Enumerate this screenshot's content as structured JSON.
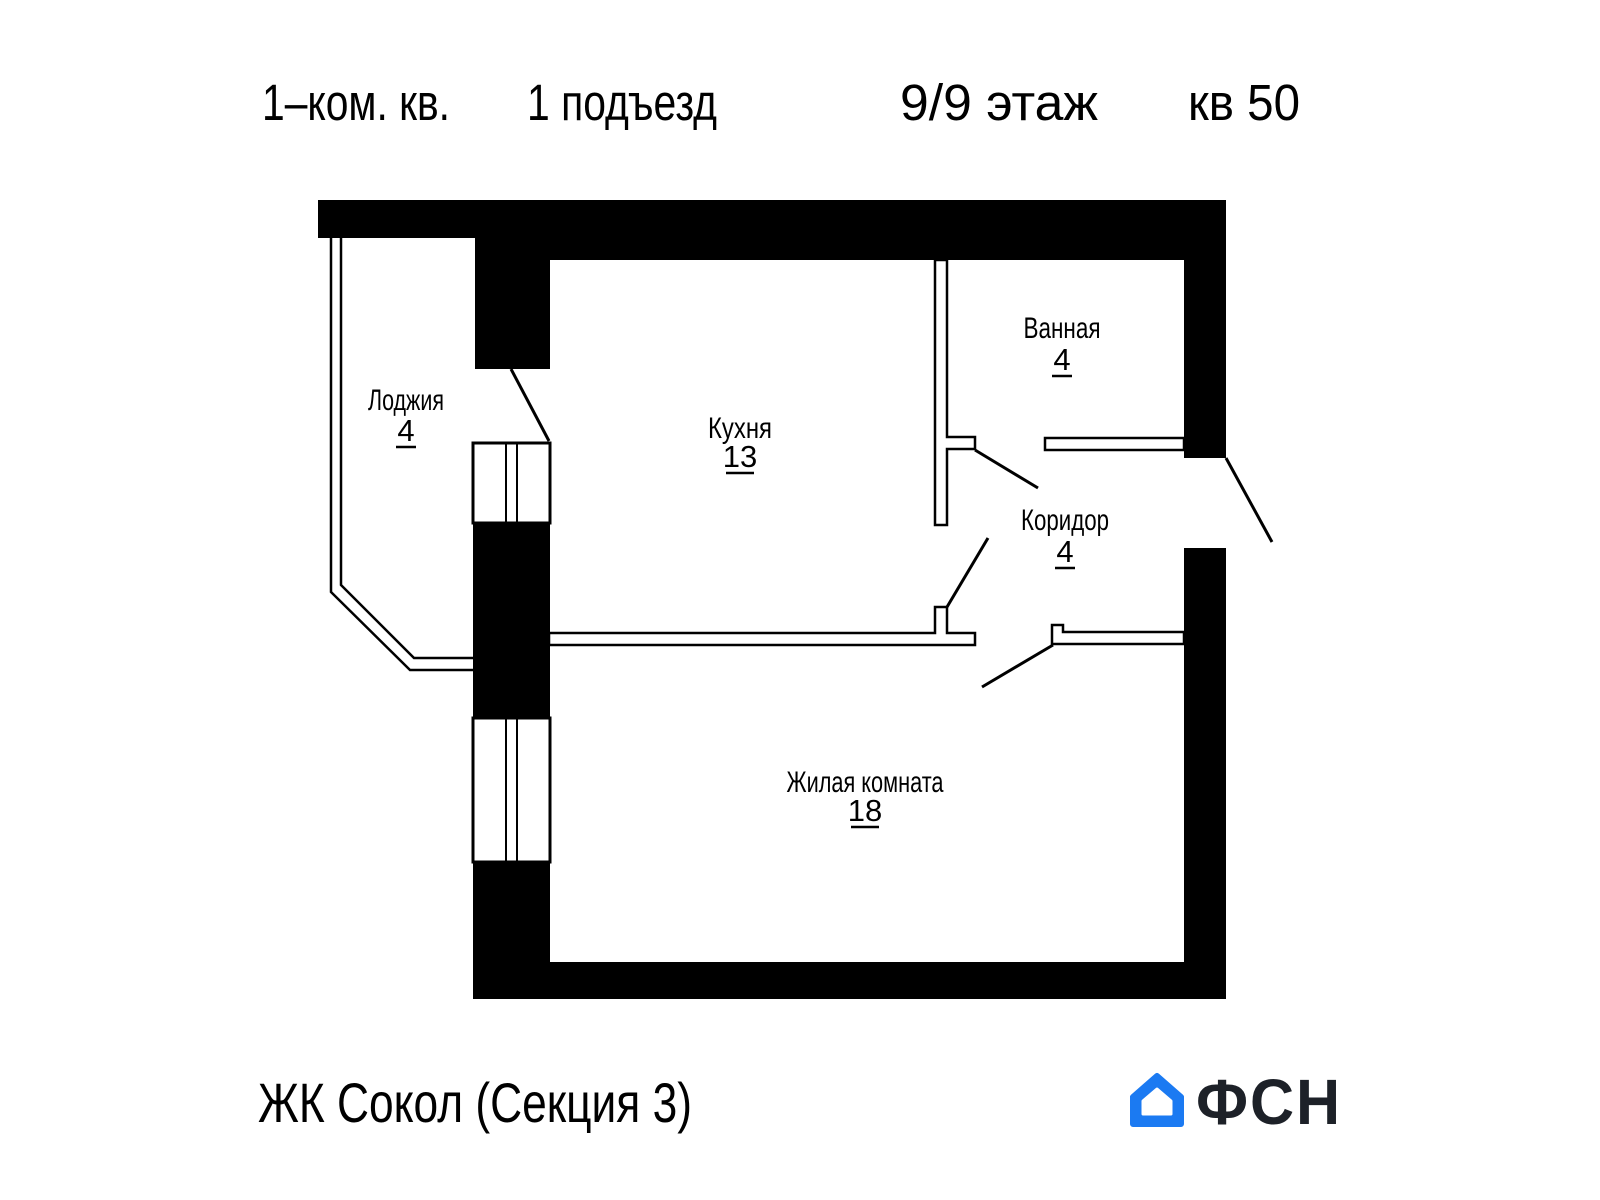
{
  "header": {
    "apartment_type": "1–ком. кв.",
    "entrance": "1 подъезд",
    "floor": "9/9 этаж",
    "unit": "кв 50"
  },
  "plan": {
    "rooms": [
      {
        "name": "Лоджия",
        "area": "4"
      },
      {
        "name": "Кухня",
        "area": "13"
      },
      {
        "name": "Ванная",
        "area": "4"
      },
      {
        "name": "Коридор",
        "area": "4"
      },
      {
        "name": "Жилая комната",
        "area": "18"
      }
    ]
  },
  "footer": {
    "project": "ЖК Сокол (Секция 3)",
    "logo_text": "ФСН"
  },
  "colors": {
    "wall": "#000000",
    "logo_blue": "#1b7af2",
    "logo_dark": "#1d2128"
  }
}
